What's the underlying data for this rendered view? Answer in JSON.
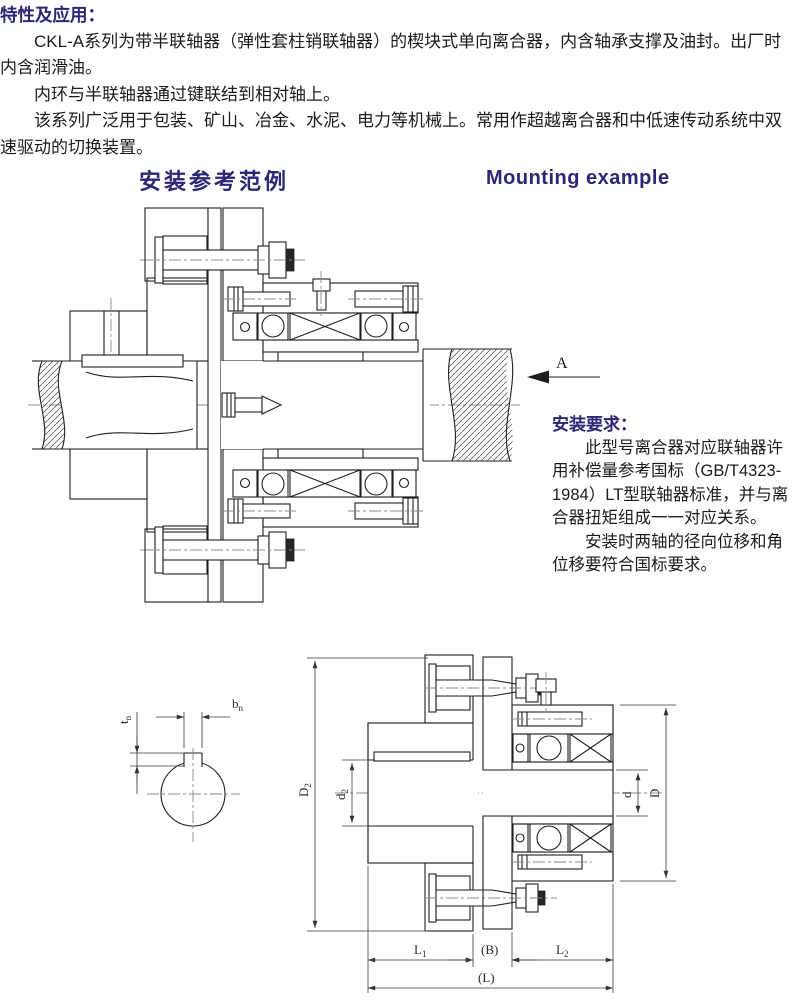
{
  "page": {
    "background": "#ffffff",
    "accent_color": "#2b2676",
    "text_color": "#1b1b1b"
  },
  "intro": {
    "heading": "特性及应用：",
    "p1": "CKL-A系列为带半联轴器（弹性套柱销联轴器）的楔块式单向离合器，内含轴承支撑及油封。出厂时内含润滑油。",
    "p2": "内环与半联轴器通过键联结到相对轴上。",
    "p3": "该系列广泛用于包装、矿山、冶金、水泥、电力等机械上。常用作超越离合器和中低速传动系统中双速驱动的切换装置。"
  },
  "titles": {
    "zh": "安装参考范例",
    "en": "Mounting example"
  },
  "mounting_view": {
    "arrow_label": "A"
  },
  "requirements": {
    "heading": "安装要求：",
    "p1": "此型号离合器对应联轴器许用补偿量参考国标（GB/T4323-1984）LT型联轴器标准，并与离合器扭矩组成一一对应关系。",
    "p2": "安装时两轴的径向位移和角位移要符合国标要求。"
  },
  "dims": {
    "key_width": {
      "base": "b",
      "sub": "n"
    },
    "key_depth": {
      "base": "t",
      "sub": "n"
    },
    "coupling_od": {
      "base": "D",
      "sub": "2"
    },
    "coupling_bore": {
      "base": "d",
      "sub": "2"
    },
    "clutch_bore": {
      "base": "d",
      "sub": ""
    },
    "clutch_od": {
      "base": "D",
      "sub": ""
    },
    "len_left": {
      "base": "L",
      "sub": "1"
    },
    "gap": {
      "base": "(B)",
      "sub": ""
    },
    "len_right": {
      "base": "L",
      "sub": "2"
    },
    "len_total": {
      "base": "(L)",
      "sub": ""
    }
  }
}
